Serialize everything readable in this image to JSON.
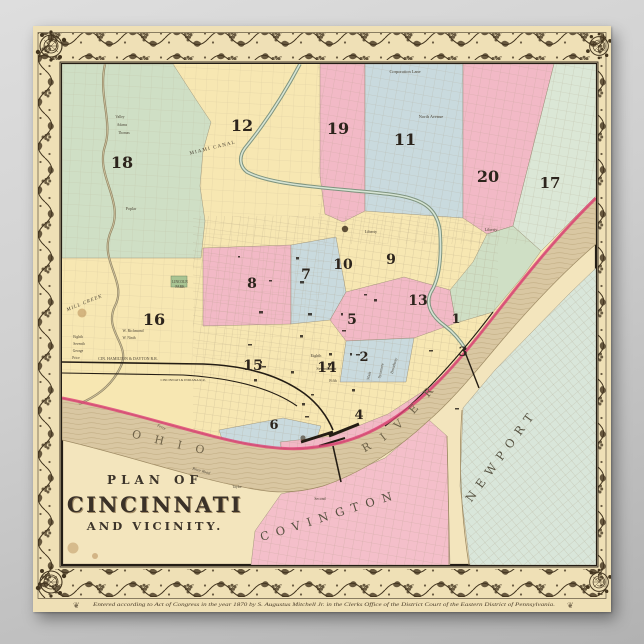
{
  "page": {
    "background_top": "#dedede",
    "background_bottom": "#b2b2b2"
  },
  "poster": {
    "kind": "antique-map-poster",
    "paper_color": "#efe0b6",
    "border_ink": "#43351f",
    "title": {
      "line1": "PLAN OF",
      "line2": "CINCINNATI",
      "line3": "AND VICINITY."
    },
    "river": {
      "word1": "OHIO",
      "word2": "RIVER"
    },
    "cities": [
      {
        "name": "COVINGTON"
      },
      {
        "name": "NEWPORT"
      }
    ],
    "copyright": "Entered according to Act of Congress in the year 1870 by S. Augustus Mitchell Jr. in the Clerks Office of the District Court of the Eastern District of Pennsylvania.",
    "colors": {
      "map_base": "#f3e5bd",
      "ward_yellow": "#f7e7b2",
      "ward_pink": "#f2b9c6",
      "ward_green": "#cfdfc5",
      "ward_blue": "#c9dade",
      "ward_palegreen": "#dbe7d6",
      "covington_pink": "#f4bfca",
      "newport_palegreen": "#d9e6da",
      "river_tan": "#d9c7a2",
      "riverbank_red": "#dd3f74",
      "canal_green": "#7f947f",
      "rail_black": "#241d14"
    },
    "ward_numbers": [
      {
        "n": "18",
        "x": 89,
        "y": 142,
        "s": 16
      },
      {
        "n": "12",
        "x": 209,
        "y": 105,
        "s": 16
      },
      {
        "n": "19",
        "x": 305,
        "y": 108,
        "s": 16
      },
      {
        "n": "11",
        "x": 372,
        "y": 119,
        "s": 16
      },
      {
        "n": "20",
        "x": 455,
        "y": 156,
        "s": 16
      },
      {
        "n": "17",
        "x": 517,
        "y": 162,
        "s": 15
      },
      {
        "n": "16",
        "x": 121,
        "y": 299,
        "s": 16
      },
      {
        "n": "8",
        "x": 219,
        "y": 262,
        "s": 14
      },
      {
        "n": "7",
        "x": 273,
        "y": 253,
        "s": 14
      },
      {
        "n": "10",
        "x": 310,
        "y": 243,
        "s": 14
      },
      {
        "n": "9",
        "x": 358,
        "y": 238,
        "s": 14
      },
      {
        "n": "5",
        "x": 319,
        "y": 298,
        "s": 14
      },
      {
        "n": "13",
        "x": 385,
        "y": 279,
        "s": 14
      },
      {
        "n": "15",
        "x": 220,
        "y": 344,
        "s": 14
      },
      {
        "n": "14",
        "x": 294,
        "y": 346,
        "s": 14
      },
      {
        "n": "2",
        "x": 331,
        "y": 335,
        "s": 13
      },
      {
        "n": "1",
        "x": 423,
        "y": 297,
        "s": 13
      },
      {
        "n": "3",
        "x": 430,
        "y": 330,
        "s": 13
      },
      {
        "n": "4",
        "x": 326,
        "y": 393,
        "s": 13
      },
      {
        "n": "6",
        "x": 241,
        "y": 403,
        "s": 13
      }
    ],
    "labels": [
      {
        "text": "Corporation Lane",
        "x": 372,
        "y": 47,
        "s": 4.4
      },
      {
        "text": "North Avenue",
        "x": 398,
        "y": 92,
        "s": 4.4
      },
      {
        "text": "Liberty",
        "x": 458,
        "y": 205,
        "s": 4.4
      },
      {
        "text": "Liberty",
        "x": 338,
        "y": 207,
        "s": 4.2
      },
      {
        "text": "MIAMI CANAL",
        "x": 180,
        "y": 123,
        "s": 5,
        "r": -14,
        "sp": 1.2
      },
      {
        "text": "MILL CREEK",
        "x": 52,
        "y": 278,
        "s": 5,
        "r": -22,
        "i": 1,
        "sp": 1
      },
      {
        "text": "LINCOLN",
        "x": 147,
        "y": 257,
        "s": 3.6
      },
      {
        "text": "PARK",
        "x": 147,
        "y": 262,
        "s": 3.6
      },
      {
        "text": "CIN. HAMILTON & DAYTON R.R.",
        "x": 95,
        "y": 334,
        "s": 4
      },
      {
        "text": "CINCINNATI & INDIANA R.R.",
        "x": 150,
        "y": 355,
        "s": 3.4
      },
      {
        "text": "River Road",
        "x": 168,
        "y": 446,
        "s": 4,
        "r": 16,
        "i": 1
      },
      {
        "text": "Ferry",
        "x": 128,
        "y": 402,
        "s": 3.8,
        "r": 24,
        "i": 1
      },
      {
        "text": "Taylor",
        "x": 204,
        "y": 462,
        "s": 3.6
      },
      {
        "text": "Valley",
        "x": 87,
        "y": 92,
        "s": 3.6
      },
      {
        "text": "Adams",
        "x": 89,
        "y": 100,
        "s": 3.6
      },
      {
        "text": "Thomas",
        "x": 91,
        "y": 108,
        "s": 3.6
      },
      {
        "text": "Poplar",
        "x": 98,
        "y": 184,
        "s": 4
      },
      {
        "text": "Eighth",
        "x": 45,
        "y": 312,
        "s": 3.6
      },
      {
        "text": "Seventh",
        "x": 46,
        "y": 319,
        "s": 3.6
      },
      {
        "text": "George",
        "x": 45,
        "y": 326,
        "s": 3.6
      },
      {
        "text": "Price",
        "x": 43,
        "y": 333,
        "s": 3.6
      },
      {
        "text": "W. Richmond",
        "x": 100,
        "y": 306,
        "s": 3.8
      },
      {
        "text": "W. Ninth",
        "x": 96,
        "y": 313,
        "s": 3.6
      },
      {
        "text": "Eighth",
        "x": 283,
        "y": 331,
        "s": 4
      },
      {
        "text": "Seventh",
        "x": 290,
        "y": 344,
        "s": 4
      },
      {
        "text": "Main",
        "x": 337,
        "y": 350,
        "s": 4,
        "r": -78
      },
      {
        "text": "Broadway",
        "x": 362,
        "y": 340,
        "s": 4,
        "r": -75
      },
      {
        "text": "Sycamore",
        "x": 349,
        "y": 345,
        "s": 3.8,
        "r": -77
      },
      {
        "text": "Second",
        "x": 287,
        "y": 474,
        "s": 3.8
      },
      {
        "text": "Fifth",
        "x": 300,
        "y": 356,
        "s": 3.8
      }
    ]
  }
}
